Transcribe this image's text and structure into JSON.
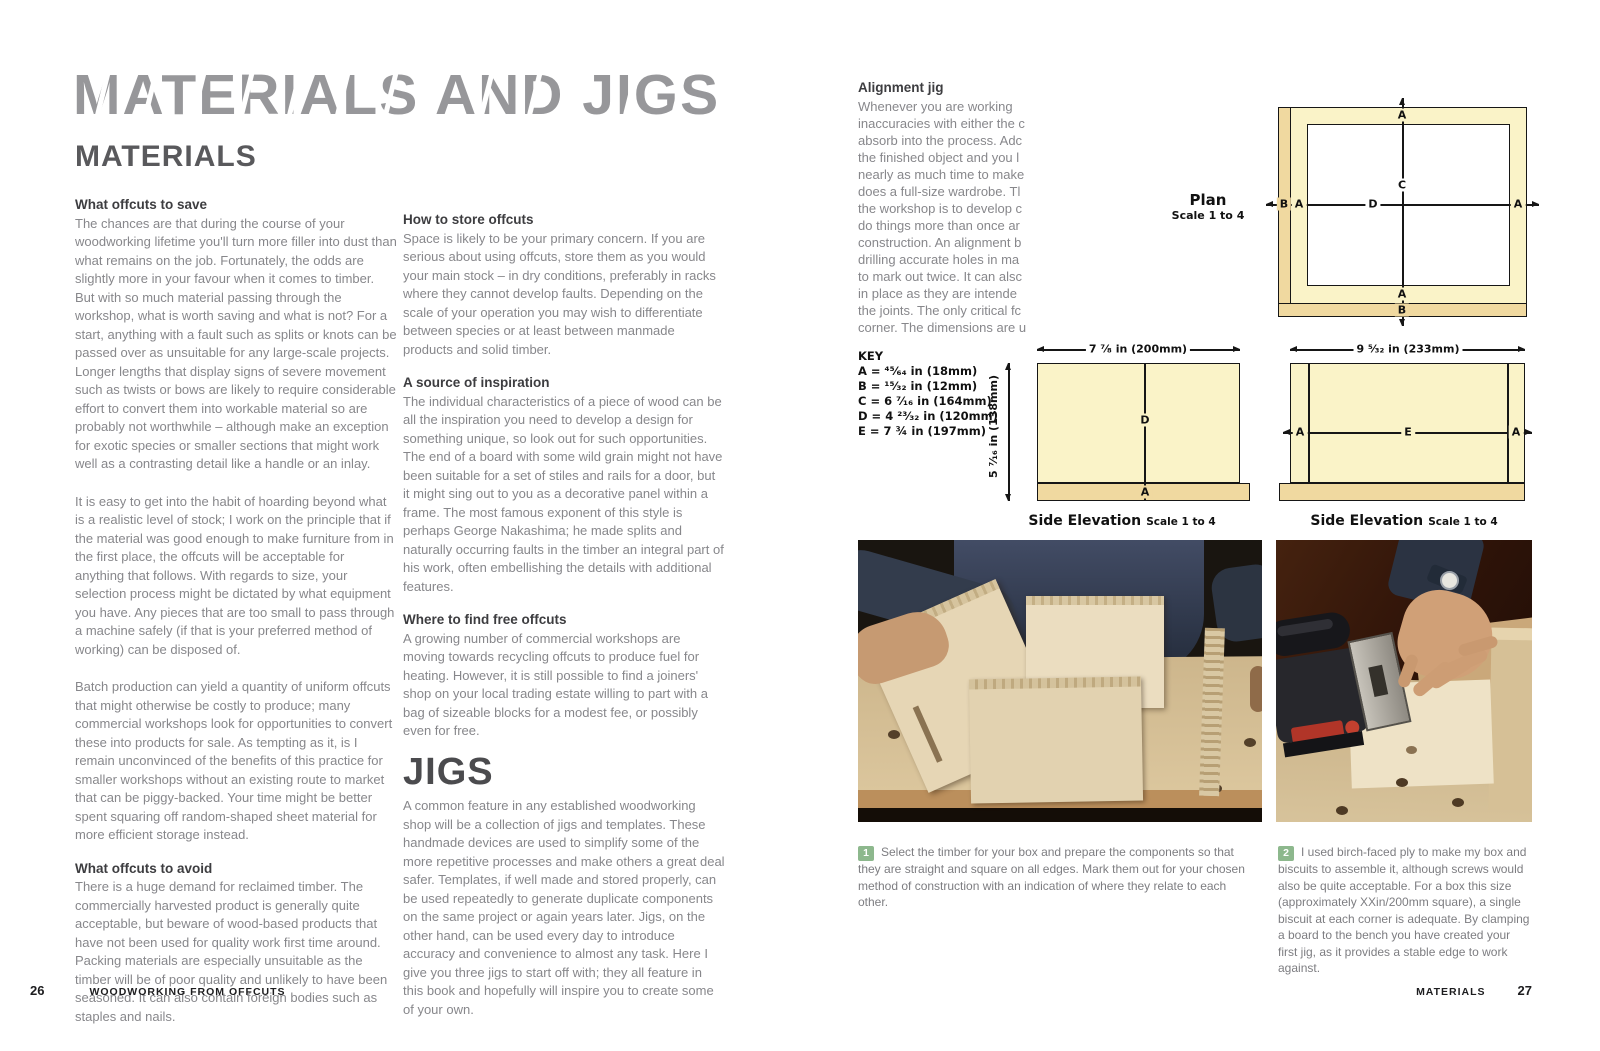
{
  "left_page": {
    "chapter_title": "MATERIALS AND JIGS",
    "section_title": "MATERIALS",
    "h1": "What offcuts to save",
    "p1": "The chances are that during the course of your woodworking lifetime you'll turn more filler into dust than what remains on the job. Fortunately, the odds are slightly more in your favour when it comes to timber. But with so much material passing through the workshop, what is worth saving and what is not? For a start, anything with a fault such as splits or knots can be passed over as unsuitable for any large-scale projects. Longer lengths that display signs of severe movement such as twists or bows are likely to require considerable effort to convert them into workable material so are probably not worthwhile – although make an exception for exotic species or smaller sections that might work well as a contrasting detail like a handle or an inlay.",
    "p2": "It is easy to get into the habit of hoarding beyond what is a realistic level of stock; I work on the principle that if the material was good enough to make furniture from in the first place, the offcuts will be acceptable for anything that follows. With regards to size, your selection process might be dictated by what equipment you have. Any pieces that are too small to pass through a machine safely (if that is your preferred method of working) can be disposed of.",
    "p3": "Batch production can yield a quantity of uniform offcuts that might otherwise be costly to produce; many commercial workshops look for opportunities to convert these into products for sale. As tempting as it, is I remain unconvinced of the benefits of this practice for smaller workshops without an existing route to market that can be piggy-backed. Your time might be better spent squaring off random-shaped sheet material for more efficient storage instead.",
    "h2": "What offcuts to avoid",
    "p4": "There is a huge demand for reclaimed timber. The commercially harvested product is generally quite acceptable, but beware of wood-based products that have not been used for quality work first time around. Packing materials are especially unsuitable as the timber will be of poor quality and unlikely to have been seasoned. It can also contain foreign bodies such as staples and nails.",
    "h3": "How to store offcuts",
    "p5": "Space is likely to be your primary concern. If you are serious about using offcuts, store them as you would your main stock – in dry conditions, preferably in racks where they cannot develop faults. Depending on the scale of your operation you may wish to differentiate between species or at least between manmade products and solid timber.",
    "h4": "A source of inspiration",
    "p6": "The individual characteristics of a piece of wood can be all the inspiration you need to develop a design for something unique, so look out for such opportunities. The end of a board with some wild grain might not have been suitable for a set of stiles and rails for a door, but it might sing out to you as a decorative panel within a frame. The most famous exponent of this style is perhaps George Nakashima; he made splits and naturally occurring faults in the timber an integral part of his work, often embellishing the details with additional features.",
    "h5": "Where to find free offcuts",
    "p7": "A growing number of commercial workshops are moving towards recycling offcuts to produce fuel for heating. However, it is still possible to find a joiners' shop on your local trading estate willing to part with a bag of sizeable blocks for a modest fee, or possibly even for free.",
    "jigs_title": "JIGS",
    "p8": "A common feature in any established woodworking shop will be a collection of jigs and templates. These handmade devices are used to simplify some of the more repetitive processes and make others a great deal safer. Templates, if well made and stored properly, can be used repeatedly to generate duplicate components on the same project or again years later. Jigs, on the other hand, can be used every day to introduce accuracy and convenience to almost any task. Here I give you three jigs to start off with; they all feature in this book and hopefully will inspire you to create some of your own."
  },
  "right_page": {
    "alignment_heading": "Alignment jig",
    "alignment_lines": [
      "Whenever you are working",
      "inaccuracies with either the c",
      "absorb into the process. Adc",
      "the finished object and you l",
      "nearly as much time to make",
      "does a full-size wardrobe. Tl",
      "the workshop is to develop c",
      "do things more than once ar",
      "construction. An alignment b",
      "drilling accurate holes in ma",
      "to mark out twice. It can alsc",
      "in place as they are intende",
      "the joints. The only critical fc",
      "corner. The dimensions are u"
    ],
    "key": {
      "title": "KEY",
      "items": [
        "A = ⁴⁵⁄₆₄ in (18mm)",
        "B = ¹⁵⁄₃₂ in (12mm)",
        "C = 6 ⁷⁄₁₆ in (164mm)",
        "D = 4 ²³⁄₃₂ in (120mm)",
        "E = 7 ¾ in (197mm)"
      ]
    },
    "plan": {
      "label": "Plan",
      "scale": "Scale 1 to 4",
      "dim_top": "A",
      "dim_center_v": "C",
      "dim_bottom": "A",
      "dim_bottom_edge": "B",
      "dim_left_edge": "B",
      "dim_left": "A",
      "dim_center_h": "D",
      "dim_right": "A"
    },
    "elev1": {
      "caption": "Side Elevation",
      "scale": "Scale 1 to 4",
      "dim_width": "7 ⁷⁄₈ in (200mm)",
      "dim_height": "5 ⁷⁄₁₆ in (138mm)",
      "dim_center": "D",
      "dim_base": "A"
    },
    "elev2": {
      "caption": "Side Elevation",
      "scale": "Scale 1 to 4",
      "dim_width": "9 ⁵⁄₃₂ in (233mm)",
      "dim_left": "A",
      "dim_center": "E",
      "dim_right": "A"
    },
    "steps": [
      {
        "num": "1",
        "text": "Select the timber for your box and prepare the components so that they are straight and square on all edges. Mark them out for your chosen method of construction with an indication of where they relate to each other."
      },
      {
        "num": "2",
        "text": "I used birch-faced ply to make my box and biscuits to assemble it, although screws would also be quite acceptable. For a box this size (approximately XXin/200mm square), a single biscuit at each corner is adequate. By clamping a board to the bench you have created your first jig, as it provides a stable edge to work against."
      }
    ]
  },
  "footer": {
    "page_left": "26",
    "book_title": "WOODWORKING FROM OFFCUTS",
    "section": "MATERIALS",
    "page_right": "27"
  },
  "colors": {
    "badge_green": "#8db88d",
    "diagram_pale": "#faf3c8",
    "diagram_tan": "#f0d9a0",
    "title_gray": "#97979a"
  }
}
